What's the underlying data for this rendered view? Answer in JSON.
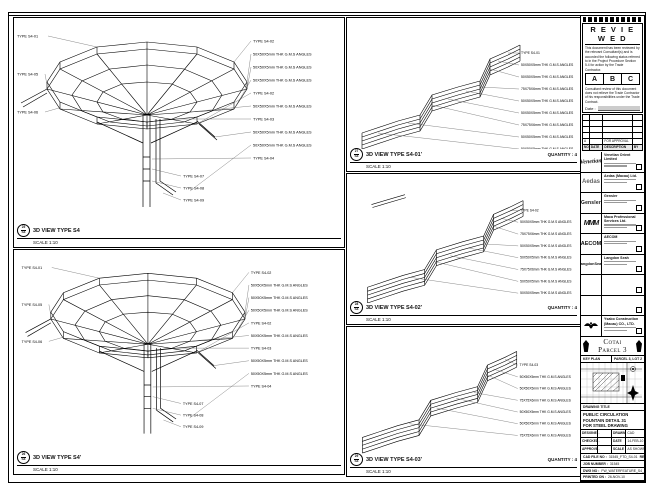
{
  "left_panels": [
    {
      "bubble_top": "25",
      "bubble_bottom": "S4",
      "title": "3D VIEW TYPE S4",
      "scale": "SCALE 1:10",
      "callouts_left": [
        "TYPE S4-01",
        "TYPE S4-05",
        "TYPE S4-06"
      ],
      "callouts_right": [
        "TYPE S4-02",
        "50X50X5mm THK G.M.S ANGLES",
        "50X50X5mm THK G.M.S ANGLES",
        "50X50X5mm THK G.M.S ANGLES",
        "TYPE S4-02",
        "50X50X5mm THK G.M.S ANGLES",
        "TYPE S4-03",
        "50X50X5mm THK G.M.S ANGLES",
        "50X50X5mm THK G.M.S ANGLES",
        "TYPE S4-04"
      ],
      "callouts_bottom": [
        "TYPE S4-07",
        "TYPE S4-08",
        "TYPE S4-09"
      ]
    },
    {
      "bubble_top": "26",
      "bubble_bottom": "S4",
      "title": "3D VIEW TYPE S4'",
      "scale": "SCALE 1:10",
      "callouts_left": [
        "TYPE S4-01",
        "TYPE S4-05",
        "TYPE S4-06"
      ],
      "callouts_right": [
        "TYPE S4-02",
        "50X50X5mm THK G.M.S ANGLES",
        "50X50X5mm THK G.M.S ANGLES",
        "50X50X5mm THK G.M.S ANGLES",
        "TYPE S4-02",
        "50X50X5mm THK G.M.S ANGLES",
        "TYPE S4-03",
        "50X50X5mm THK G.M.S ANGLES",
        "50X50X5mm THK G.M.S ANGLES",
        "TYPE S4-04"
      ],
      "callouts_bottom": [
        "TYPE S4-07",
        "TYPE S4-08",
        "TYPE S4-09"
      ]
    }
  ],
  "mid_panels": [
    {
      "bubble_top": "27",
      "bubble_bottom": "S4",
      "title": "3D VIEW TYPE S4-01'",
      "quantity": "QUANTITY : 4",
      "scale": "SCALE 1:10",
      "callouts": [
        "TYPE S4-01",
        "50X50X5mm THK G.M.S ANGLES",
        "50X50X5mm THK G.M.S ANGLES",
        "75X75X6mm THK G.M.S ANGLES",
        "50X50X5mm THK G.M.S ANGLES",
        "50X50X5mm THK G.M.S ANGLES",
        "75X75X6mm THK G.M.S ANGLES",
        "50X50X5mm THK G.M.S ANGLES",
        "50X50X5mm THK G.M.S ANGLES"
      ]
    },
    {
      "bubble_top": "28",
      "bubble_bottom": "S4",
      "title": "3D VIEW TYPE S4-02'",
      "quantity": "QUANTITY : 4",
      "scale": "SCALE 1:10",
      "callouts": [
        "TYPE S4-02",
        "50X50X5mm THK G.M.S ANGLES",
        "75X75X6mm THK G.M.S ANGLES",
        "50X50X5mm THK G.M.S ANGLES",
        "50X50X5mm THK G.M.S ANGLES",
        "75X75X6mm THK G.M.S ANGLES",
        "50X50X5mm THK G.M.S ANGLES",
        "50X50X5mm THK G.M.S ANGLES"
      ]
    },
    {
      "bubble_top": "29",
      "bubble_bottom": "S4",
      "title": "3D VIEW TYPE S4-03'",
      "quantity": "QUANTITY : 4",
      "scale": "SCALE 1:10",
      "callouts": [
        "TYPE S4-03",
        "50X50X5mm THK G.M.S ANGLES",
        "50X50X5mm THK G.M.S ANGLES",
        "75X75X6mm THK G.M.S ANGLES",
        "50X50X5mm THK G.M.S ANGLES",
        "50X50X5mm THK G.M.S ANGLES",
        "75X75X6mm THK G.M.S ANGLES"
      ]
    }
  ],
  "titleblock": {
    "reviewed": {
      "title": "R E V I E W E D",
      "body1": "This document has been reviewed by the relevant Consultant(s) and is accorded the following status referred to in the Project Procedure Section 5.4 for action by the Trade Contractor.",
      "grades": [
        "A",
        "B",
        "C"
      ],
      "body2": "Consultant review of this document does not relieve the Trade Contractor of his responsibilities under the Trade Contract.",
      "date_label": "Date :"
    },
    "revisions": {
      "headers": [
        "NO.",
        "DATE",
        "DESCRIPTION",
        "BY"
      ],
      "entry": {
        "no": "A",
        "date": "",
        "description": "FOR APPROVAL",
        "by": ""
      }
    },
    "consultants": [
      {
        "logo_text": "Venetian",
        "name": "Venetian Orient Limited"
      },
      {
        "logo_text": "Aedas",
        "name": "Aedas (Macau) Ltd."
      },
      {
        "logo_text": "Gensler",
        "name": "Gensler"
      },
      {
        "logo_text": "MMM",
        "name": "Maca Professional Services Ltd."
      },
      {
        "logo_text": "AECOM",
        "name": "AECOM"
      },
      {
        "logo_text": "LangdonSeah",
        "name": "Langdon Seah"
      },
      {
        "logo_text": "",
        "name": ""
      },
      {
        "logo_text": "",
        "name": ""
      },
      {
        "logo_text": "",
        "name": "Ysabo Construction (Macau) CO., LTD."
      }
    ],
    "project": "Cotai Parcel 3",
    "key_plan": {
      "left": "KEY PLAN",
      "right": "PARCEL 3, LOT 2"
    },
    "drawing_title": {
      "label": "DRAWING TITLE",
      "lines": [
        "PUBLIC CIRCULATION",
        "FOUNTAIN DETAIL 31",
        "FOR STEEL DRAWING"
      ]
    },
    "approvals": {
      "rows": [
        [
          "DESIGNED",
          "-",
          "DRAWN",
          "CAD"
        ],
        [
          "CHECKED",
          "-",
          "DATE",
          "14-FEB-10"
        ],
        [
          "APPROVED",
          "-",
          "SCALE",
          "AS SHOWN"
        ]
      ]
    },
    "footer": [
      {
        "label": "CAD FILE NO :",
        "value": "31545_FTD_S4-01",
        "right": "REV : A"
      },
      {
        "label": "JOB NUMBER :",
        "value": "31545",
        "right": ""
      },
      {
        "label": "DWG NO :",
        "value": "FW_WATERFEATURE_S4_(DRAWING)",
        "right": ""
      },
      {
        "label": "PRINTED ON :",
        "value": "26-NOV-10",
        "right": ""
      }
    ]
  }
}
